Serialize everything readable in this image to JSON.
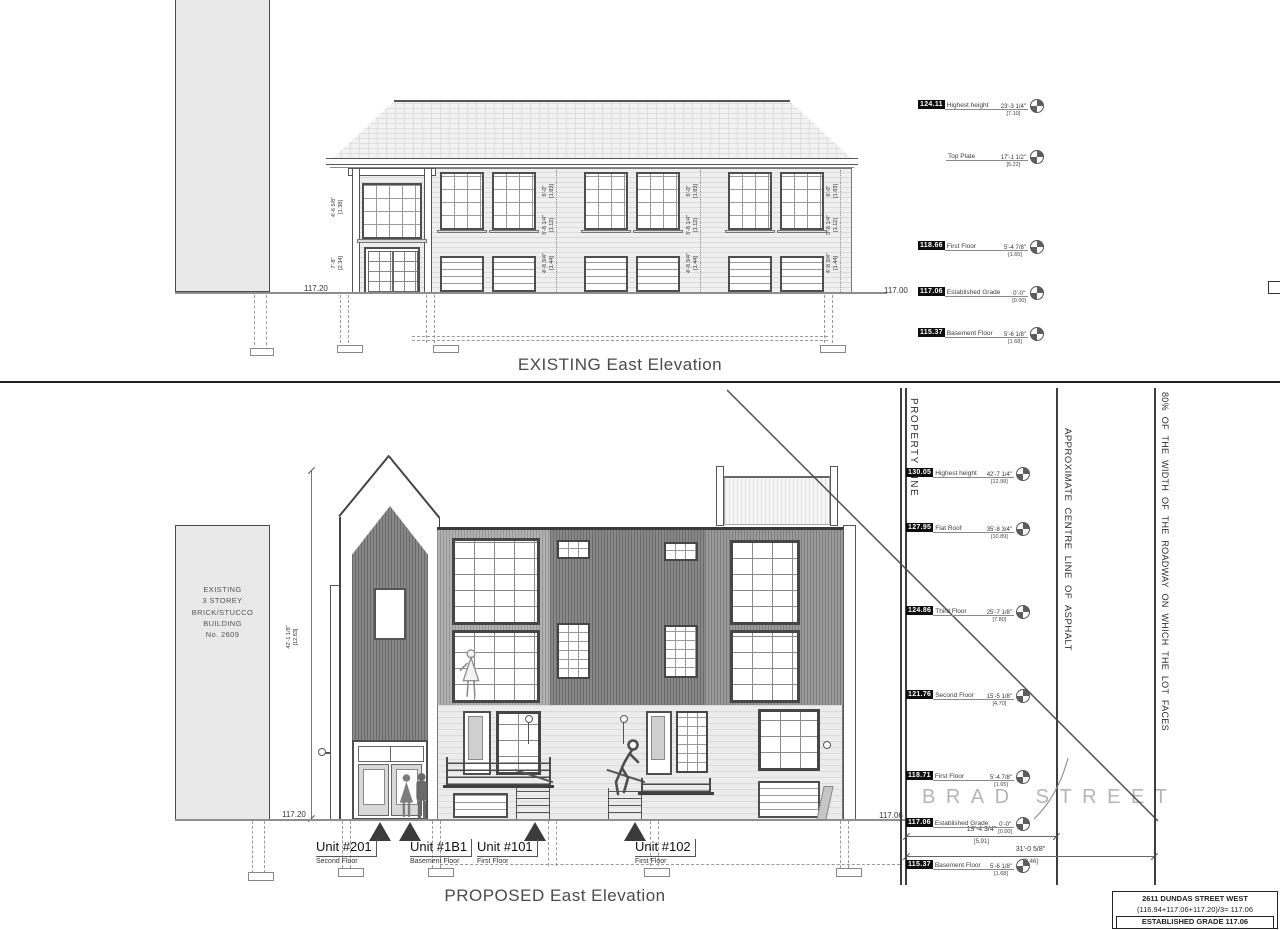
{
  "existing": {
    "title": "EXISTING East Elevation",
    "grade_left": "117.20",
    "grade_right": "117.00",
    "markers": [
      {
        "value": "124.11",
        "label": "Highest height",
        "ft": "23'-3 1/4\"",
        "m": "[7.10]"
      },
      {
        "value": "",
        "label": "Top Plate",
        "ft": "17'-1 1/2\"",
        "m": "[5.22]"
      },
      {
        "value": "118.66",
        "label": "First Floor",
        "ft": "5'-4 7/8\"",
        "m": "[1.65]"
      },
      {
        "value": "117.06",
        "label": "Established Grade",
        "ft": "0'-0\"",
        "m": "[0.00]"
      },
      {
        "value": "115.37",
        "label": "Basement Floor",
        "ft": "5'-6 1/8\"",
        "m": "[1.68]"
      }
    ],
    "porch_dims": [
      {
        "ft": "4'-6 5/8\"",
        "m": "[1.38]"
      },
      {
        "ft": "7'-8\"",
        "m": "[2.34]"
      }
    ],
    "window_dims": [
      {
        "ft": "6'-0\"",
        "m": "[1.83]"
      },
      {
        "ft": "3'-8 1/4\"",
        "m": "[1.12]"
      },
      {
        "ft": "4'-8 3/4\"",
        "m": "[1.44]"
      }
    ]
  },
  "proposed": {
    "title": "PROPOSED East Elevation",
    "grade_left": "117.20",
    "grade_right": "117.06",
    "height_dim": {
      "ft": "42'-1 1/8\"",
      "m": "[12.83]"
    },
    "markers": [
      {
        "value": "130.05",
        "label": "Highest height",
        "ft": "42'-7 1/4\"",
        "m": "[12.99]"
      },
      {
        "value": "127.95",
        "label": "Flat Roof",
        "ft": "35'-8 3/4\"",
        "m": "[10.89]"
      },
      {
        "value": "124.86",
        "label": "Third Floor",
        "ft": "25'-7 1/8\"",
        "m": "[7.80]"
      },
      {
        "value": "121.76",
        "label": "Second Floor",
        "ft": "15'-5 1/8\"",
        "m": "[4.70]"
      },
      {
        "value": "118.71",
        "label": "First Floor",
        "ft": "5'-4 7/8\"",
        "m": "[1.65]"
      },
      {
        "value": "117.06",
        "label": "Established Grade",
        "ft": "0'-0\"",
        "m": "[0.00]"
      },
      {
        "value": "115.37",
        "label": "Basement Floor",
        "ft": "5'-6 1/8\"",
        "m": "[1.68]"
      }
    ],
    "neighbor_building": {
      "line1": "EXISTING",
      "line2": "3 STOREY",
      "line3": "BRICK/STUCCO",
      "line4": "BUILDING",
      "line5": "No. 2609"
    },
    "units": [
      {
        "name": "Unit #201",
        "floor": "Second Floor"
      },
      {
        "name": "Unit #1B1",
        "floor": "Basement Floor"
      },
      {
        "name": "Unit #101",
        "floor": "First Floor"
      },
      {
        "name": "Unit #102",
        "floor": "First Floor"
      }
    ],
    "street_name": "BRAD STREET",
    "road_dims": [
      {
        "ft": "19'-4 3/4\"",
        "m": "[5.91]"
      },
      {
        "ft": "31'-0 5/8\"",
        "m": "[9.46]"
      }
    ],
    "labels": {
      "property_line": "PROPERTY LINE",
      "centre_line": "APPROXIMATE CENTRE LINE OF ASPHALT",
      "roadway": "80% OF THE WIDTH OF THE ROADWAY ON WHICH THE LOT FACES"
    }
  },
  "titleblock": {
    "address": "2611 DUNDAS STREET WEST",
    "calc": "(116.94+117.06+117.20)/3=  117.06",
    "established": "ESTABLISHED GRADE  117.06"
  },
  "colors": {
    "dark_siding": "#8a8a8a",
    "light_fill": "#e9e9e9",
    "linework": "#4a4a4a",
    "street_text": "#b5b5b5"
  }
}
